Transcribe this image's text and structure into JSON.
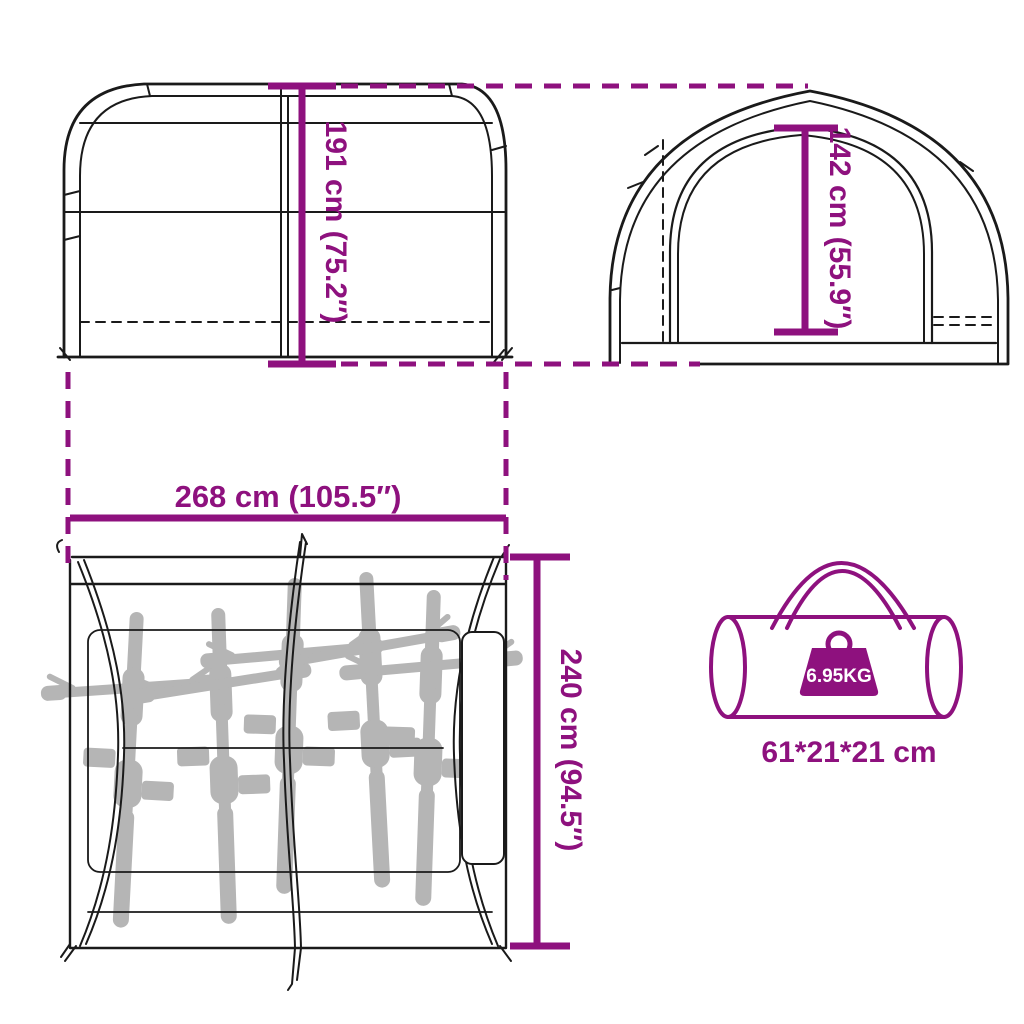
{
  "title": "Bike storage tent dimensions diagram",
  "colors": {
    "accent": "#8E117E",
    "line": "#1a1a1a",
    "bike": "#b5b5b5",
    "background": "#ffffff",
    "weight_label_text": "#ffffff"
  },
  "views": {
    "side_view": {
      "name": "tent side view",
      "height_label": "191 cm (75.2″)"
    },
    "front_view": {
      "name": "tent front view",
      "door_height_label": "142 cm (55.9″)"
    },
    "top_view": {
      "name": "tent top view with bicycles",
      "width_label": "268 cm (105.5″)",
      "depth_label": "240 cm (94.5″)",
      "bike_count": 5
    },
    "carry_bag": {
      "name": "carry bag",
      "weight_label": "6.95KG",
      "size_label": "61*21*21 cm"
    }
  }
}
